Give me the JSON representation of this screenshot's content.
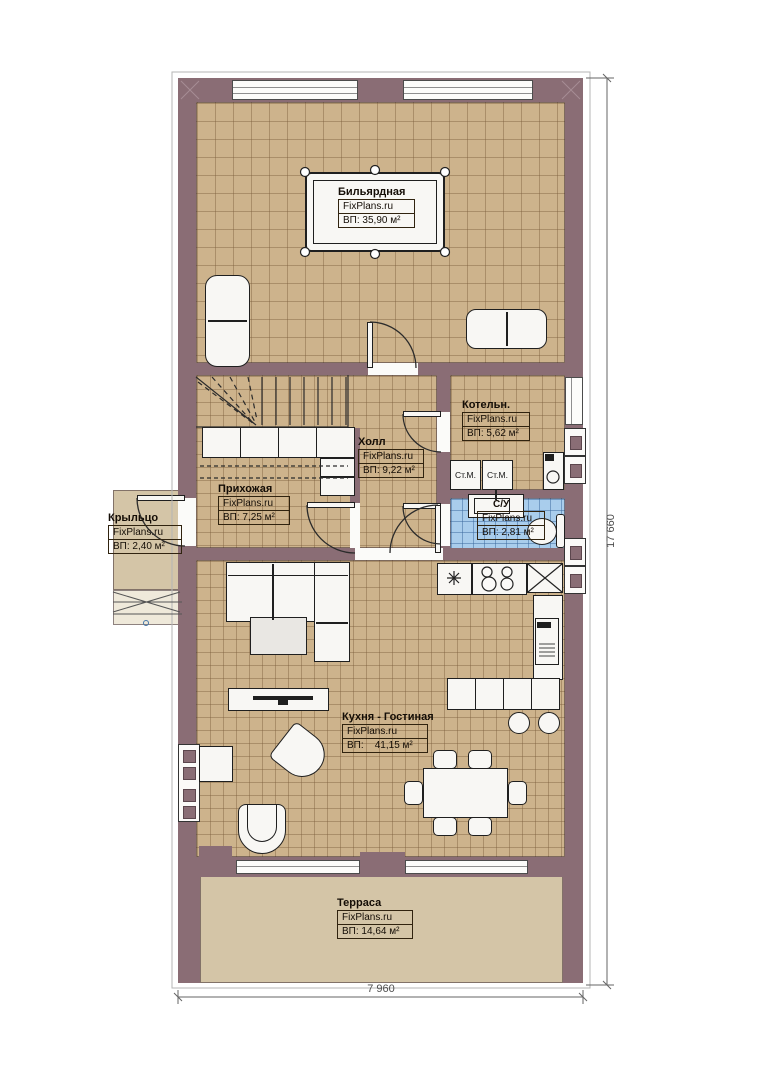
{
  "rooms": {
    "billiard": {
      "name": "Бильярдная",
      "brand": "FixPlans.ru",
      "area": "ВП: 35,90 м²"
    },
    "hall": {
      "name": "Холл",
      "brand": "FixPlans.ru",
      "area": "ВП: 9,22 м²"
    },
    "boiler": {
      "name": "Котельн.",
      "brand": "FixPlans.ru",
      "area": "ВП: 5,62 м²"
    },
    "hallway": {
      "name": "Прихожая",
      "brand": "FixPlans.ru",
      "area": "ВП: 7,25 м²"
    },
    "porch": {
      "name": "Крыльцо",
      "brand": "FixPlans.ru",
      "area": "ВП: 2,40 м²"
    },
    "wc": {
      "name": "С/У",
      "brand": "FixPlans.ru",
      "area": "ВП: 2,81 м²"
    },
    "kitchen_living": {
      "name": "Кухня - Гостиная",
      "brand": "FixPlans.ru",
      "area": "ВП:    41,15 м²"
    },
    "terrace": {
      "name": "Терраса",
      "brand": "FixPlans.ru",
      "area": "ВП: 14,64 м²"
    }
  },
  "appliances": {
    "washer_left": "Ст.М.",
    "washer_right": "Ст.М."
  },
  "dimensions": {
    "overall_width": "7 960",
    "overall_height": "17 660"
  },
  "colors": {
    "wall": "#8a6d75",
    "floor": "#cdb38c",
    "bathroom_floor": "#a9cdec",
    "terrace_floor": "#d4c5a7",
    "furniture": "#f8f7f4"
  }
}
